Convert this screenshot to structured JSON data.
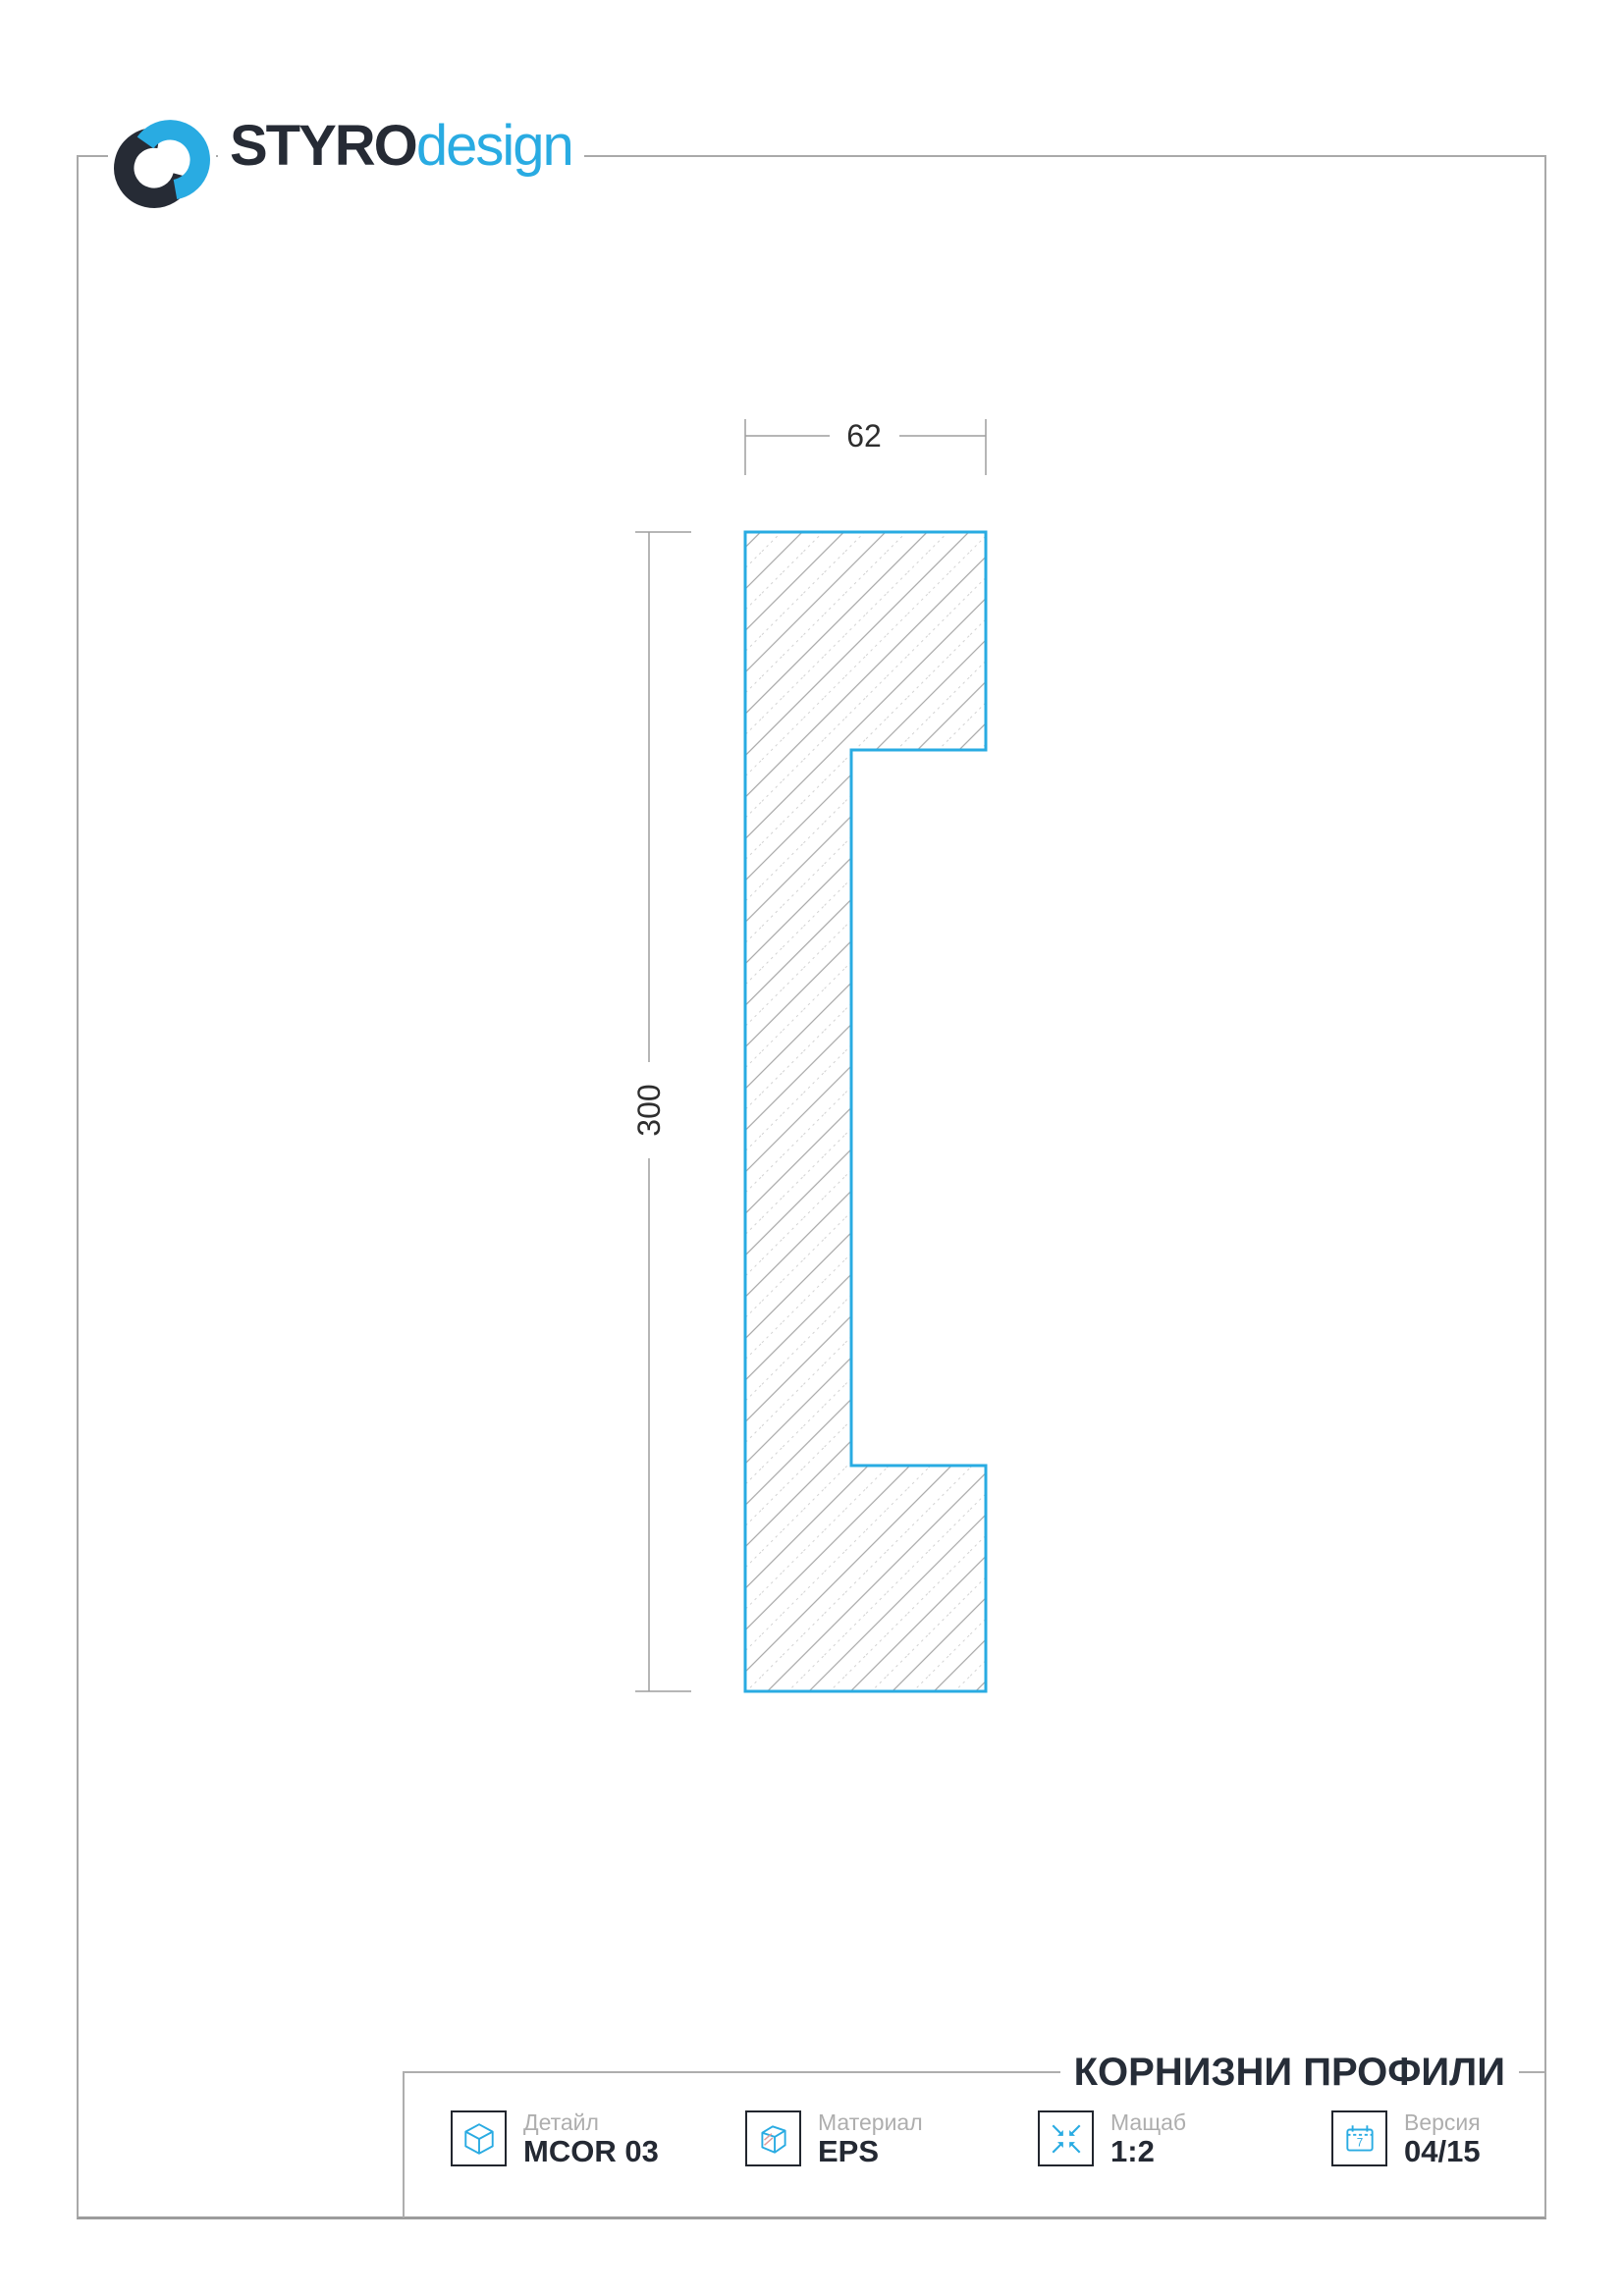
{
  "brand": {
    "primary": "STYRO",
    "secondary": "design"
  },
  "drawing": {
    "width_dim": "62",
    "height_dim": "300"
  },
  "section_title": "КОРНИЗНИ ПРОФИЛИ",
  "title_block": {
    "fields": [
      {
        "label": "Детайл",
        "value": "MCOR 03",
        "icon": "cube-icon"
      },
      {
        "label": "Материал",
        "value": "EPS",
        "icon": "material-icon"
      },
      {
        "label": "Мащаб",
        "value": "1:2",
        "icon": "scale-icon"
      },
      {
        "label": "Версия",
        "value": "04/15",
        "icon": "calendar-icon"
      }
    ]
  },
  "calendar_day": "7",
  "colors": {
    "accent_blue": "#29abe2",
    "dark_navy": "#262b35",
    "line_gray": "#a9a9a9",
    "label_gray": "#aeaeae",
    "hatch_gray": "#a6a6a6"
  }
}
